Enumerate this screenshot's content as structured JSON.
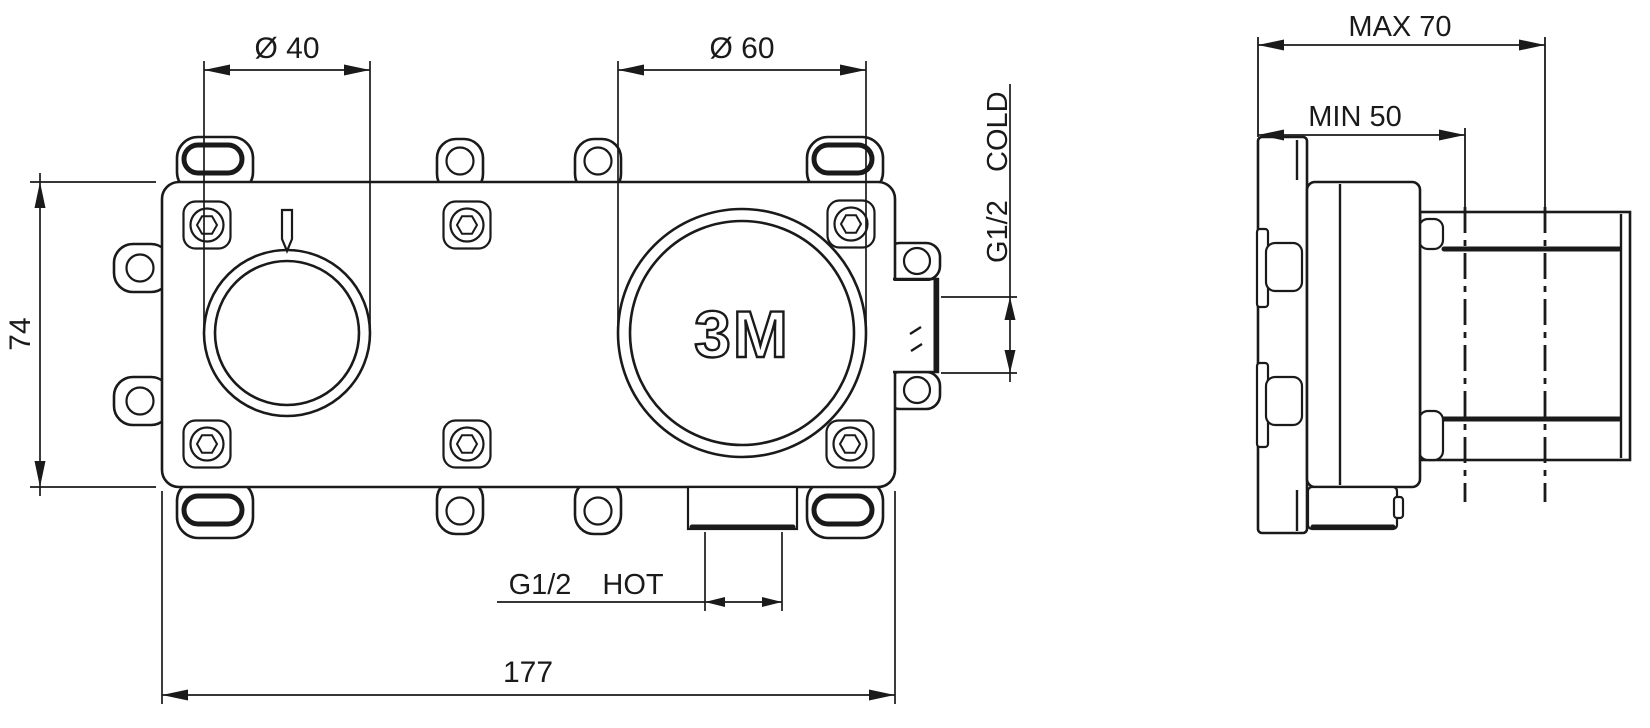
{
  "front_view": {
    "logo": "3M",
    "dim_small_circle": "Ø 40",
    "dim_large_circle": "Ø 60",
    "dim_height": "74",
    "dim_width": "177",
    "hot_inlet": {
      "thread": "G1/2",
      "label": "HOT"
    },
    "cold_inlet": {
      "thread": "G1/2",
      "label": "COLD"
    }
  },
  "side_view": {
    "dim_max_depth": "MAX 70",
    "dim_min_depth": "MIN 50"
  },
  "colors": {
    "line": "#1a1a1a",
    "background": "#ffffff"
  }
}
